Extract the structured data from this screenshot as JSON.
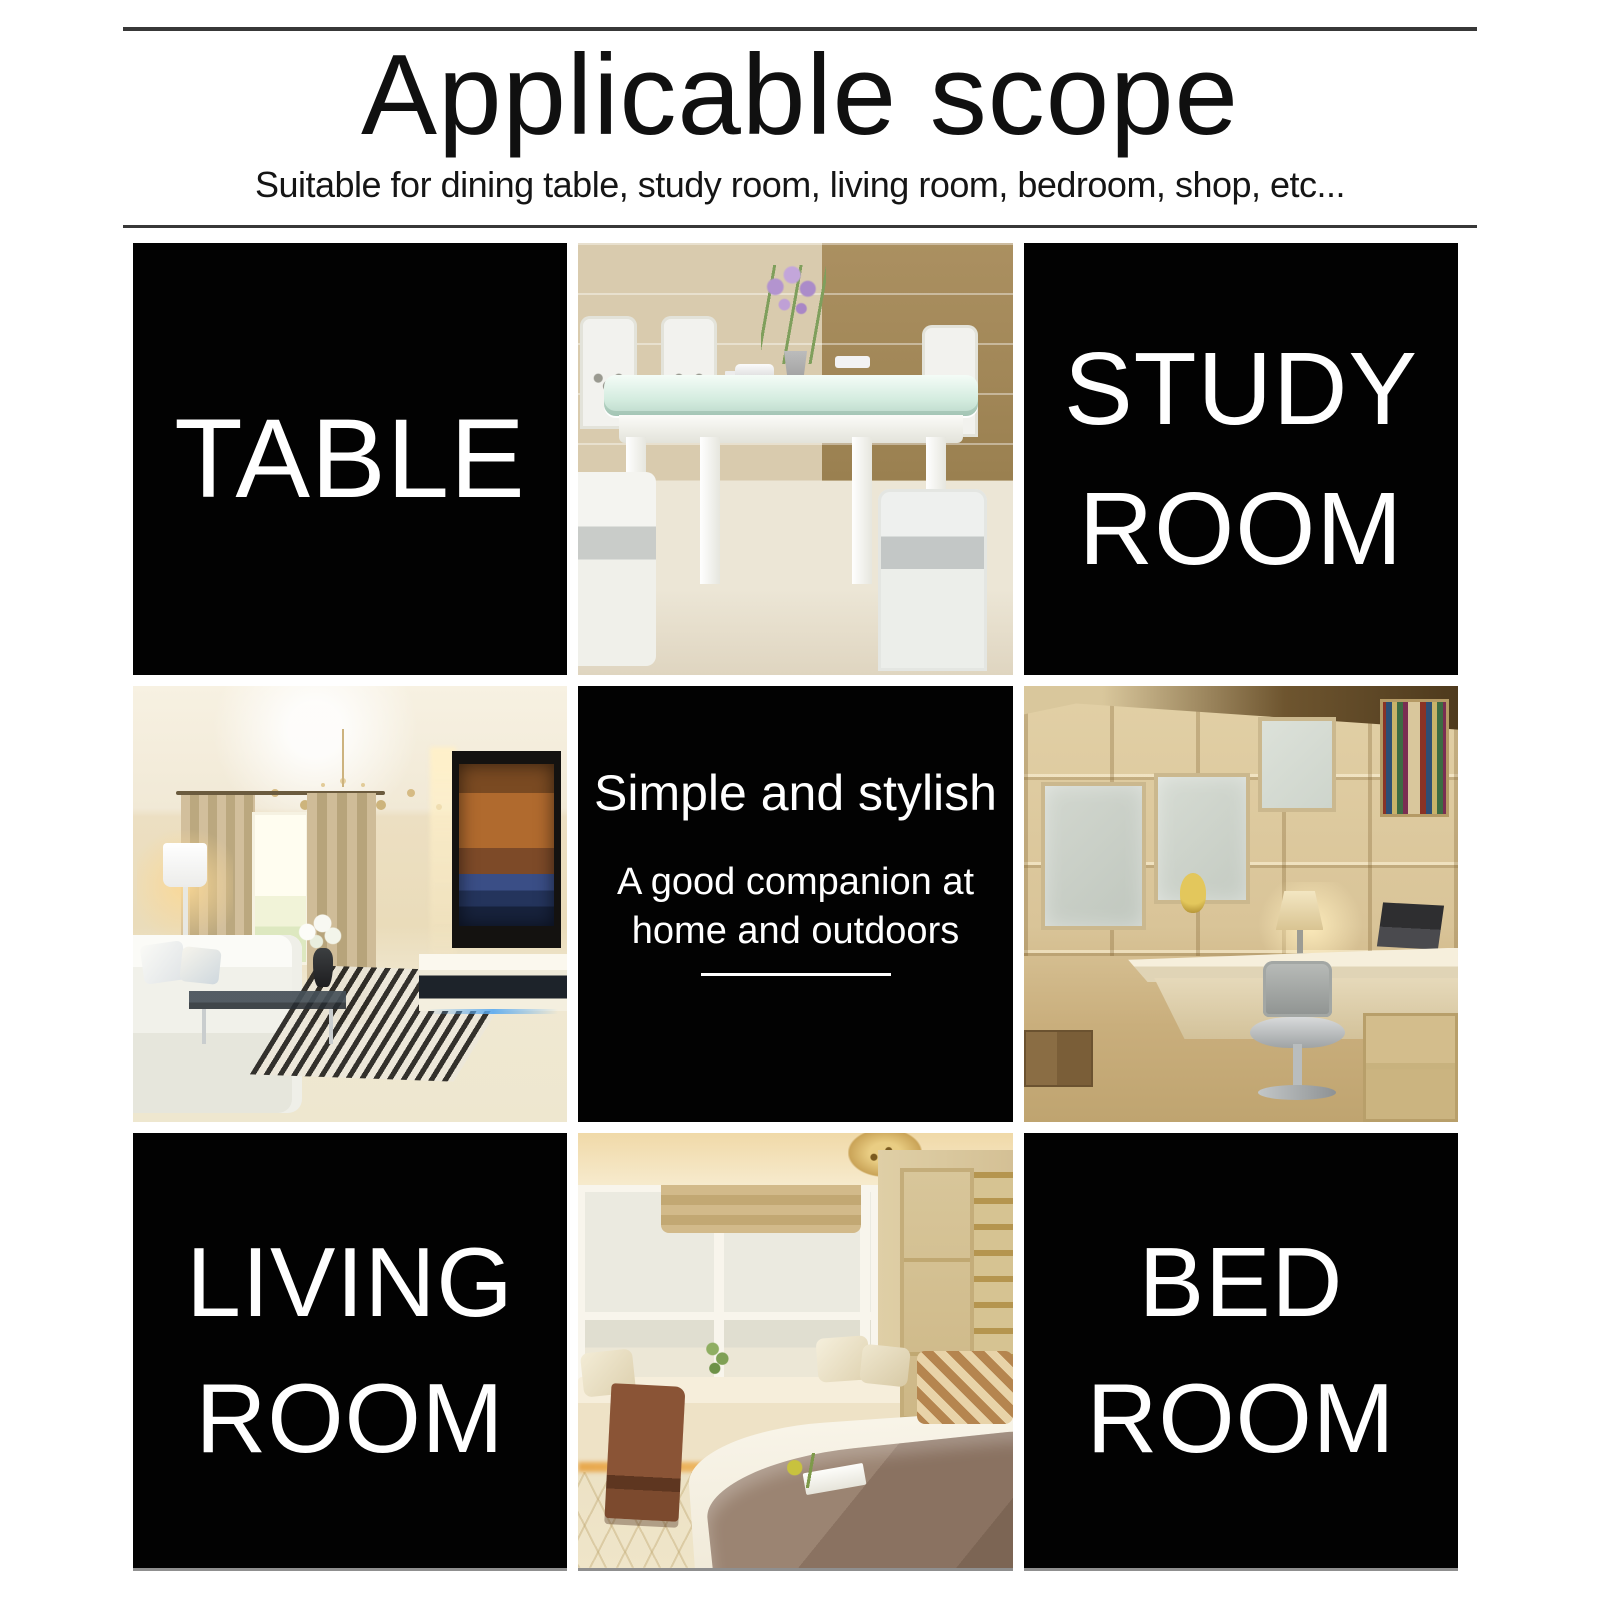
{
  "header": {
    "title": "Applicable scope",
    "subtitle": "Suitable for dining table, study room, living room, bedroom, shop, etc..."
  },
  "tiles": {
    "table": {
      "label": "TABLE"
    },
    "study_room": {
      "line1": "STUDY",
      "line2": "ROOM"
    },
    "center": {
      "heading": "Simple and stylish",
      "sub_line1": "A good companion at",
      "sub_line2": "home and outdoors"
    },
    "living_room": {
      "line1": "LIVING",
      "line2": "ROOM"
    },
    "bed_room": {
      "line1": "BED",
      "line2": "ROOM"
    }
  },
  "appearance": {
    "page_background": "#ffffff",
    "tile_background": "#020202",
    "tile_text_color": "#ffffff",
    "divider_color": "#383838",
    "bottom_edge_color": "#8f8f8f"
  }
}
